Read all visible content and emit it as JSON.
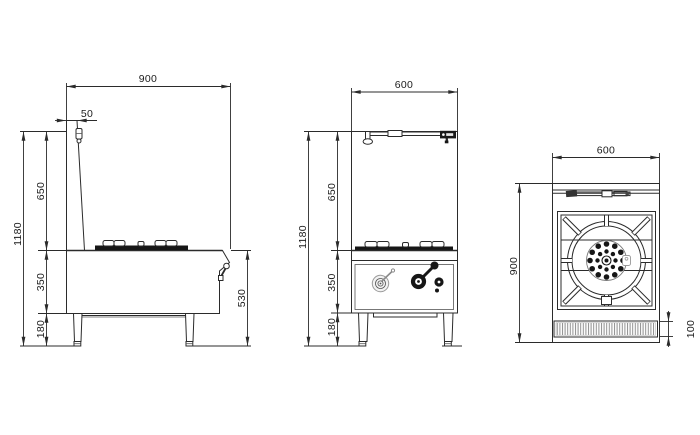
{
  "drawing": {
    "line_color": "#2b2b2b",
    "fill_color": "#161616",
    "background": "#ffffff",
    "side_view": {
      "overall_depth": "900",
      "flue_gap": "50",
      "backsplash_height": "650",
      "overall_height": "1180",
      "body_height": "350",
      "leg_height": "180",
      "worktop_height": "530"
    },
    "front_view": {
      "overall_width": "600",
      "backsplash_height": "650",
      "overall_height": "1180",
      "body_height": "350",
      "leg_height": "180"
    },
    "top_view": {
      "overall_width": "600",
      "overall_depth": "900",
      "trough_depth": "100"
    }
  }
}
